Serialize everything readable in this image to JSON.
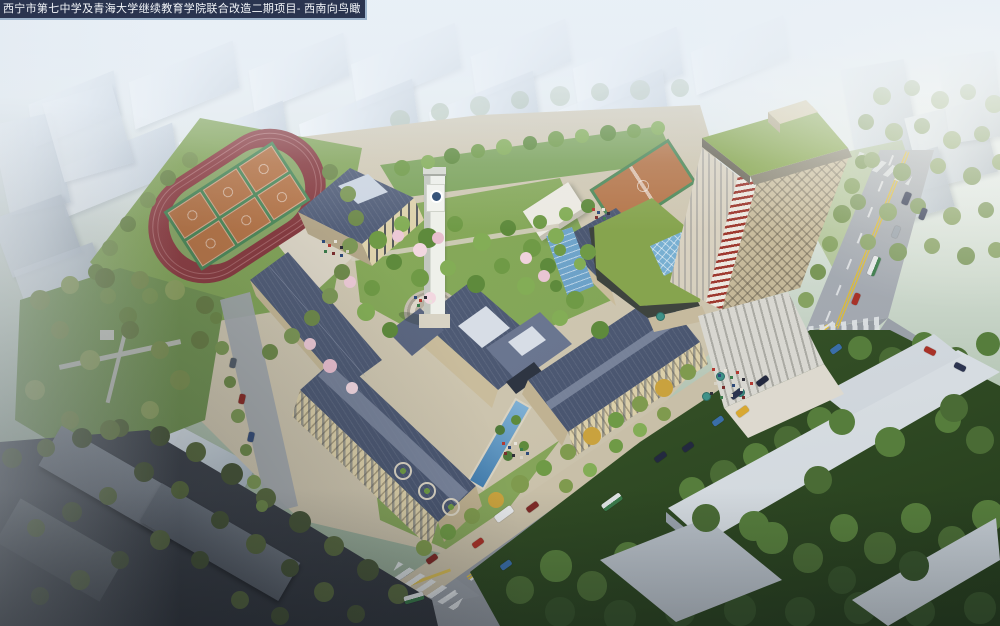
{
  "title_bar": {
    "text": "西宁市第七中学及青海大学继续教育学院联合改造二期项目- 西南向鸟瞰"
  },
  "scene": {
    "type": "aerial-architectural-rendering",
    "view": "southwest bird's-eye view of a school campus",
    "landmarks": [
      "running-track",
      "basketball-courts",
      "auditorium",
      "clock-tower",
      "classroom-wings",
      "entrance-gate",
      "water-channel",
      "high-rise-tower",
      "green-roof",
      "podium-skylight",
      "grand-steps",
      "main-road",
      "intersection",
      "city-park",
      "forest",
      "context-buildings"
    ],
    "palette": {
      "sky_haze": "#e9f0f7",
      "context_building": "#dbe3ee",
      "campus_roof_slate": "#4c5874",
      "campus_wall_beige": "#dbcfa9",
      "track_surface": "#8c3e43",
      "track_infield": "#8aa768",
      "basketball_court": "#b5764a",
      "court_surround": "#4f8a5c",
      "lawn": "#7ca35b",
      "forest": "#3b5a2b",
      "road": "#9aa1a9",
      "road_marking_yellow": "#d9ba3e",
      "tower_facade": "#c9b992",
      "tower_band_red": "#9e392f",
      "tower_roof_green": "#93b058",
      "water_blue": "#5d94c2",
      "skylight_blue": "#7fb4d4",
      "title_bar_bg": "#2a344f"
    }
  }
}
